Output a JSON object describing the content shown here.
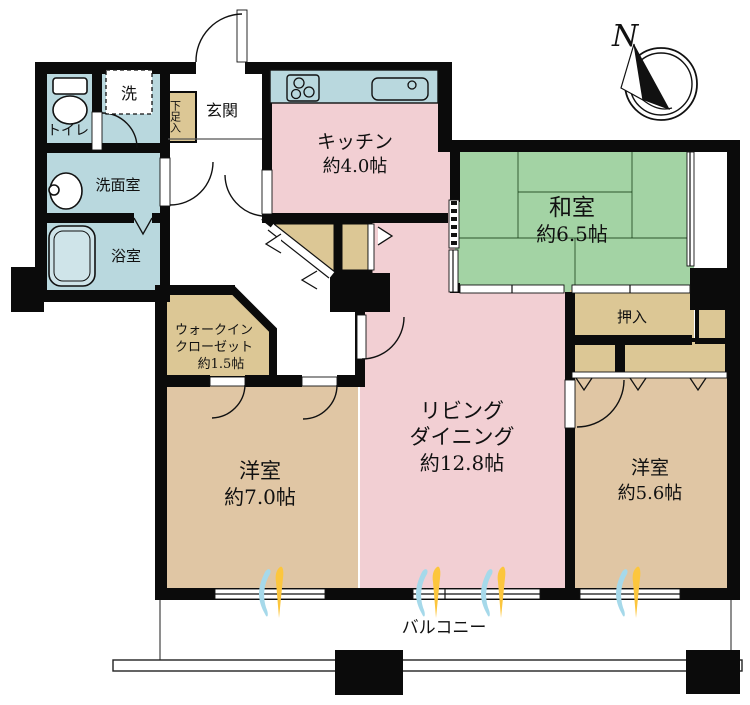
{
  "compass": {
    "north_label": "N"
  },
  "rooms": {
    "genkan": {
      "name": "玄関"
    },
    "shoebox": {
      "name": "下足入"
    },
    "toilet": {
      "name": "トイレ"
    },
    "laundry": {
      "name": "洗"
    },
    "washroom": {
      "name": "洗面室"
    },
    "bathroom": {
      "name": "浴室"
    },
    "kitchen": {
      "name": "キッチン",
      "area": "約4.0帖"
    },
    "washitsu": {
      "name": "和室",
      "area": "約6.5帖"
    },
    "oshiire": {
      "name": "押入"
    },
    "wic": {
      "name_line1": "ウォークイン",
      "name_line2": "クローゼット",
      "area": "約1.5帖"
    },
    "living_dining": {
      "name_line1": "リビング",
      "name_line2": "ダイニング",
      "area": "約12.8帖"
    },
    "western_room_large": {
      "name": "洋室",
      "area": "約7.0帖"
    },
    "western_room_small": {
      "name": "洋室",
      "area": "約5.6帖"
    },
    "balcony": {
      "name": "バルコニー"
    }
  },
  "colors": {
    "wall": "#0b0b0b",
    "water": "#b9d8de",
    "pink": "#f2cfd3",
    "tatami": "#a3d3a4",
    "closet": "#dcc795",
    "western": "#e0c6a4",
    "flameblue": "#a6d9ea",
    "flameyellow": "#fcc63d"
  }
}
